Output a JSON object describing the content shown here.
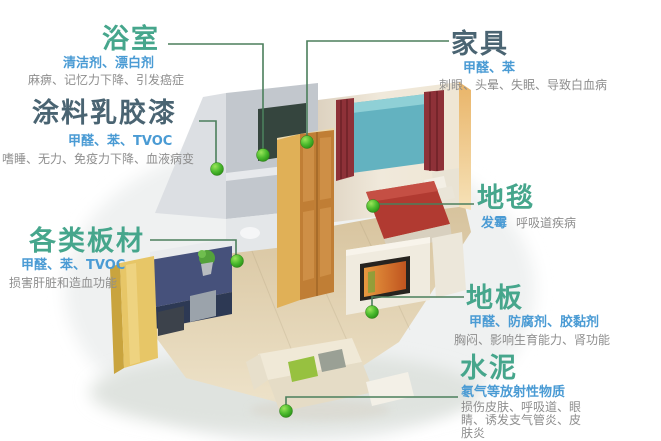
{
  "infographic": {
    "subject": "indoor-pollution-sources-room-diagram",
    "language": "zh-CN"
  },
  "colors": {
    "title_teal": "#46a68c",
    "title_dark": "#4a6472",
    "pollutant_blue": "#4a9bd4",
    "symptom_gray": "#8e8e8e",
    "connector_green": "#4b7f5c",
    "marker_green": "#3aa824",
    "background": "#ffffff"
  },
  "labels": [
    {
      "id": "bathroom",
      "title": "浴室",
      "pollutants": "清洁剂、漂白剂",
      "symptoms": "麻痹、记忆力下降、引发癌症"
    },
    {
      "id": "paint",
      "title": "涂料乳胶漆",
      "pollutants": "甲醛、苯、TVOC",
      "symptoms": "嗜睡、无力、免疫力下降、血液病变"
    },
    {
      "id": "boards",
      "title": "各类板材",
      "pollutants": "甲醛、苯、TVOC",
      "symptoms": "损害肝脏和造血功能"
    },
    {
      "id": "furniture",
      "title": "家具",
      "pollutants": "甲醛、苯",
      "symptoms": "刺眼、头晕、失眠、导致白血病"
    },
    {
      "id": "carpet",
      "title": "地毯",
      "pollutants": "发霉",
      "symptoms": "呼吸道疾病"
    },
    {
      "id": "floor",
      "title": "地板",
      "pollutants": "甲醛、防腐剂、胶黏剂",
      "symptoms": "胸闷、影响生育能力、肾功能"
    },
    {
      "id": "cement",
      "title": "水泥",
      "pollutants": "氡气等放射性物质",
      "symptoms": "损伤皮肤、呼吸道、眼睛、诱发支气管炎、皮肤炎"
    }
  ]
}
